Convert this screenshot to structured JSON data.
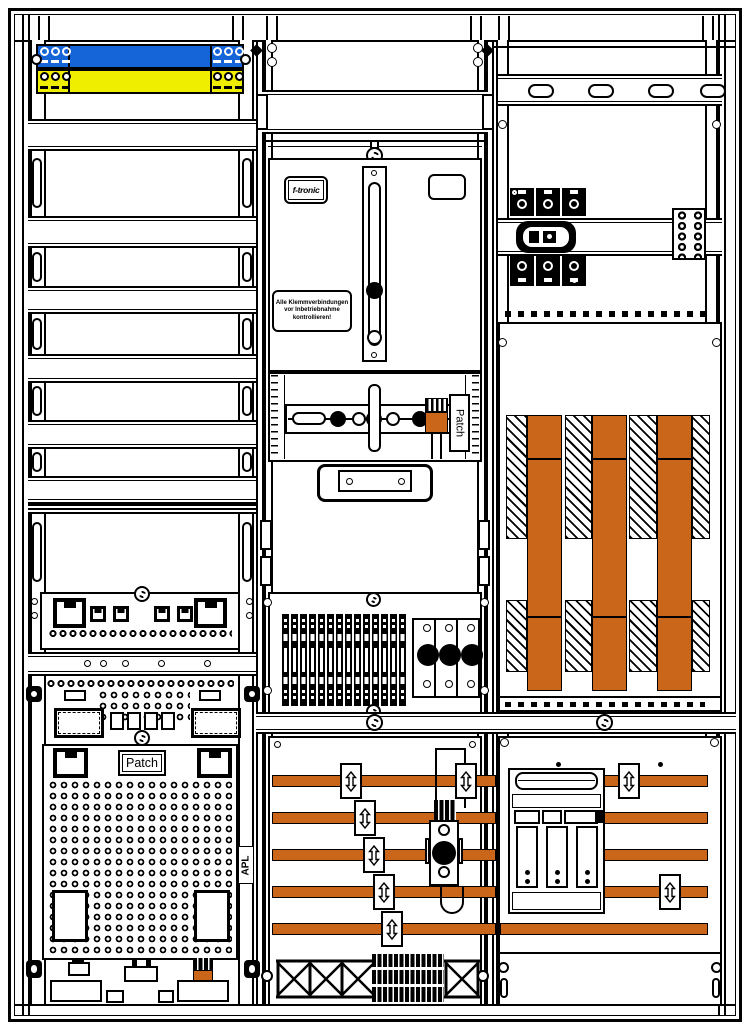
{
  "meta": {
    "kind": "electrical-cabinet-wiring-diagram",
    "fields": [
      "telecom-field-left",
      "meter-field-middle",
      "distribution-field-right"
    ]
  },
  "colors": {
    "outline": "#000000",
    "background": "#ffffff",
    "busbar_orange": "#c9661a",
    "telecom_rail_blue": "#1565d8",
    "telecom_rail_yellow": "#f0ee00"
  },
  "labels": {
    "brand": "f-tronic",
    "warning": {
      "line1": "Alle Klemmverbindungen",
      "line2": "vor Inbetriebnahme",
      "line3": "kontrollieren!"
    },
    "patch_meter_field": "Patch",
    "patch_telecom_field": "Patch",
    "apl": "APL"
  }
}
